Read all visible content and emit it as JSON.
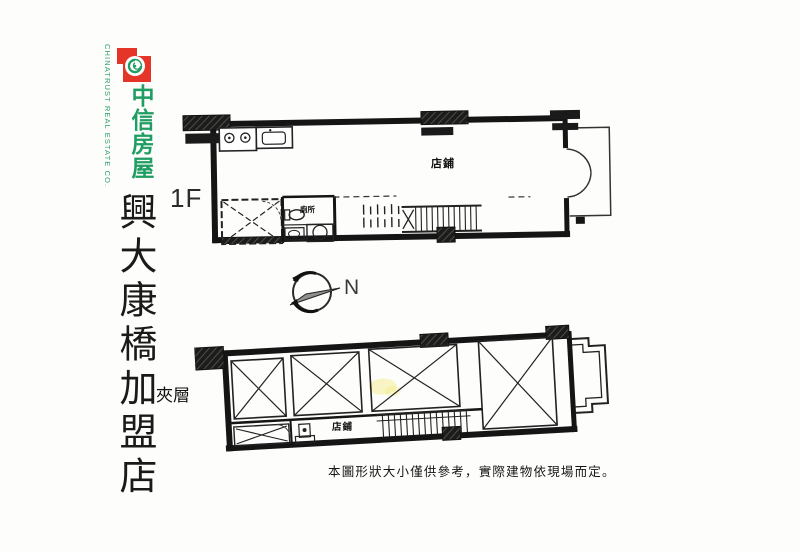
{
  "logo": {
    "company_en": "CHINATRUST REAL ESTATE CO.",
    "company_zh": "中信房屋",
    "colors": {
      "green": "#1f9d63",
      "red": "#e53528"
    }
  },
  "store_name": "興大康橋加盟店",
  "labels": {
    "floor_1f": "1F",
    "mezzanine": "夾層",
    "shop_1f": "店鋪",
    "toilet": "廁所",
    "shop_mezz": "店鋪",
    "compass_north": "N"
  },
  "disclaimer": "本圖形狀大小僅供參考，實際建物依現場而定。"
}
